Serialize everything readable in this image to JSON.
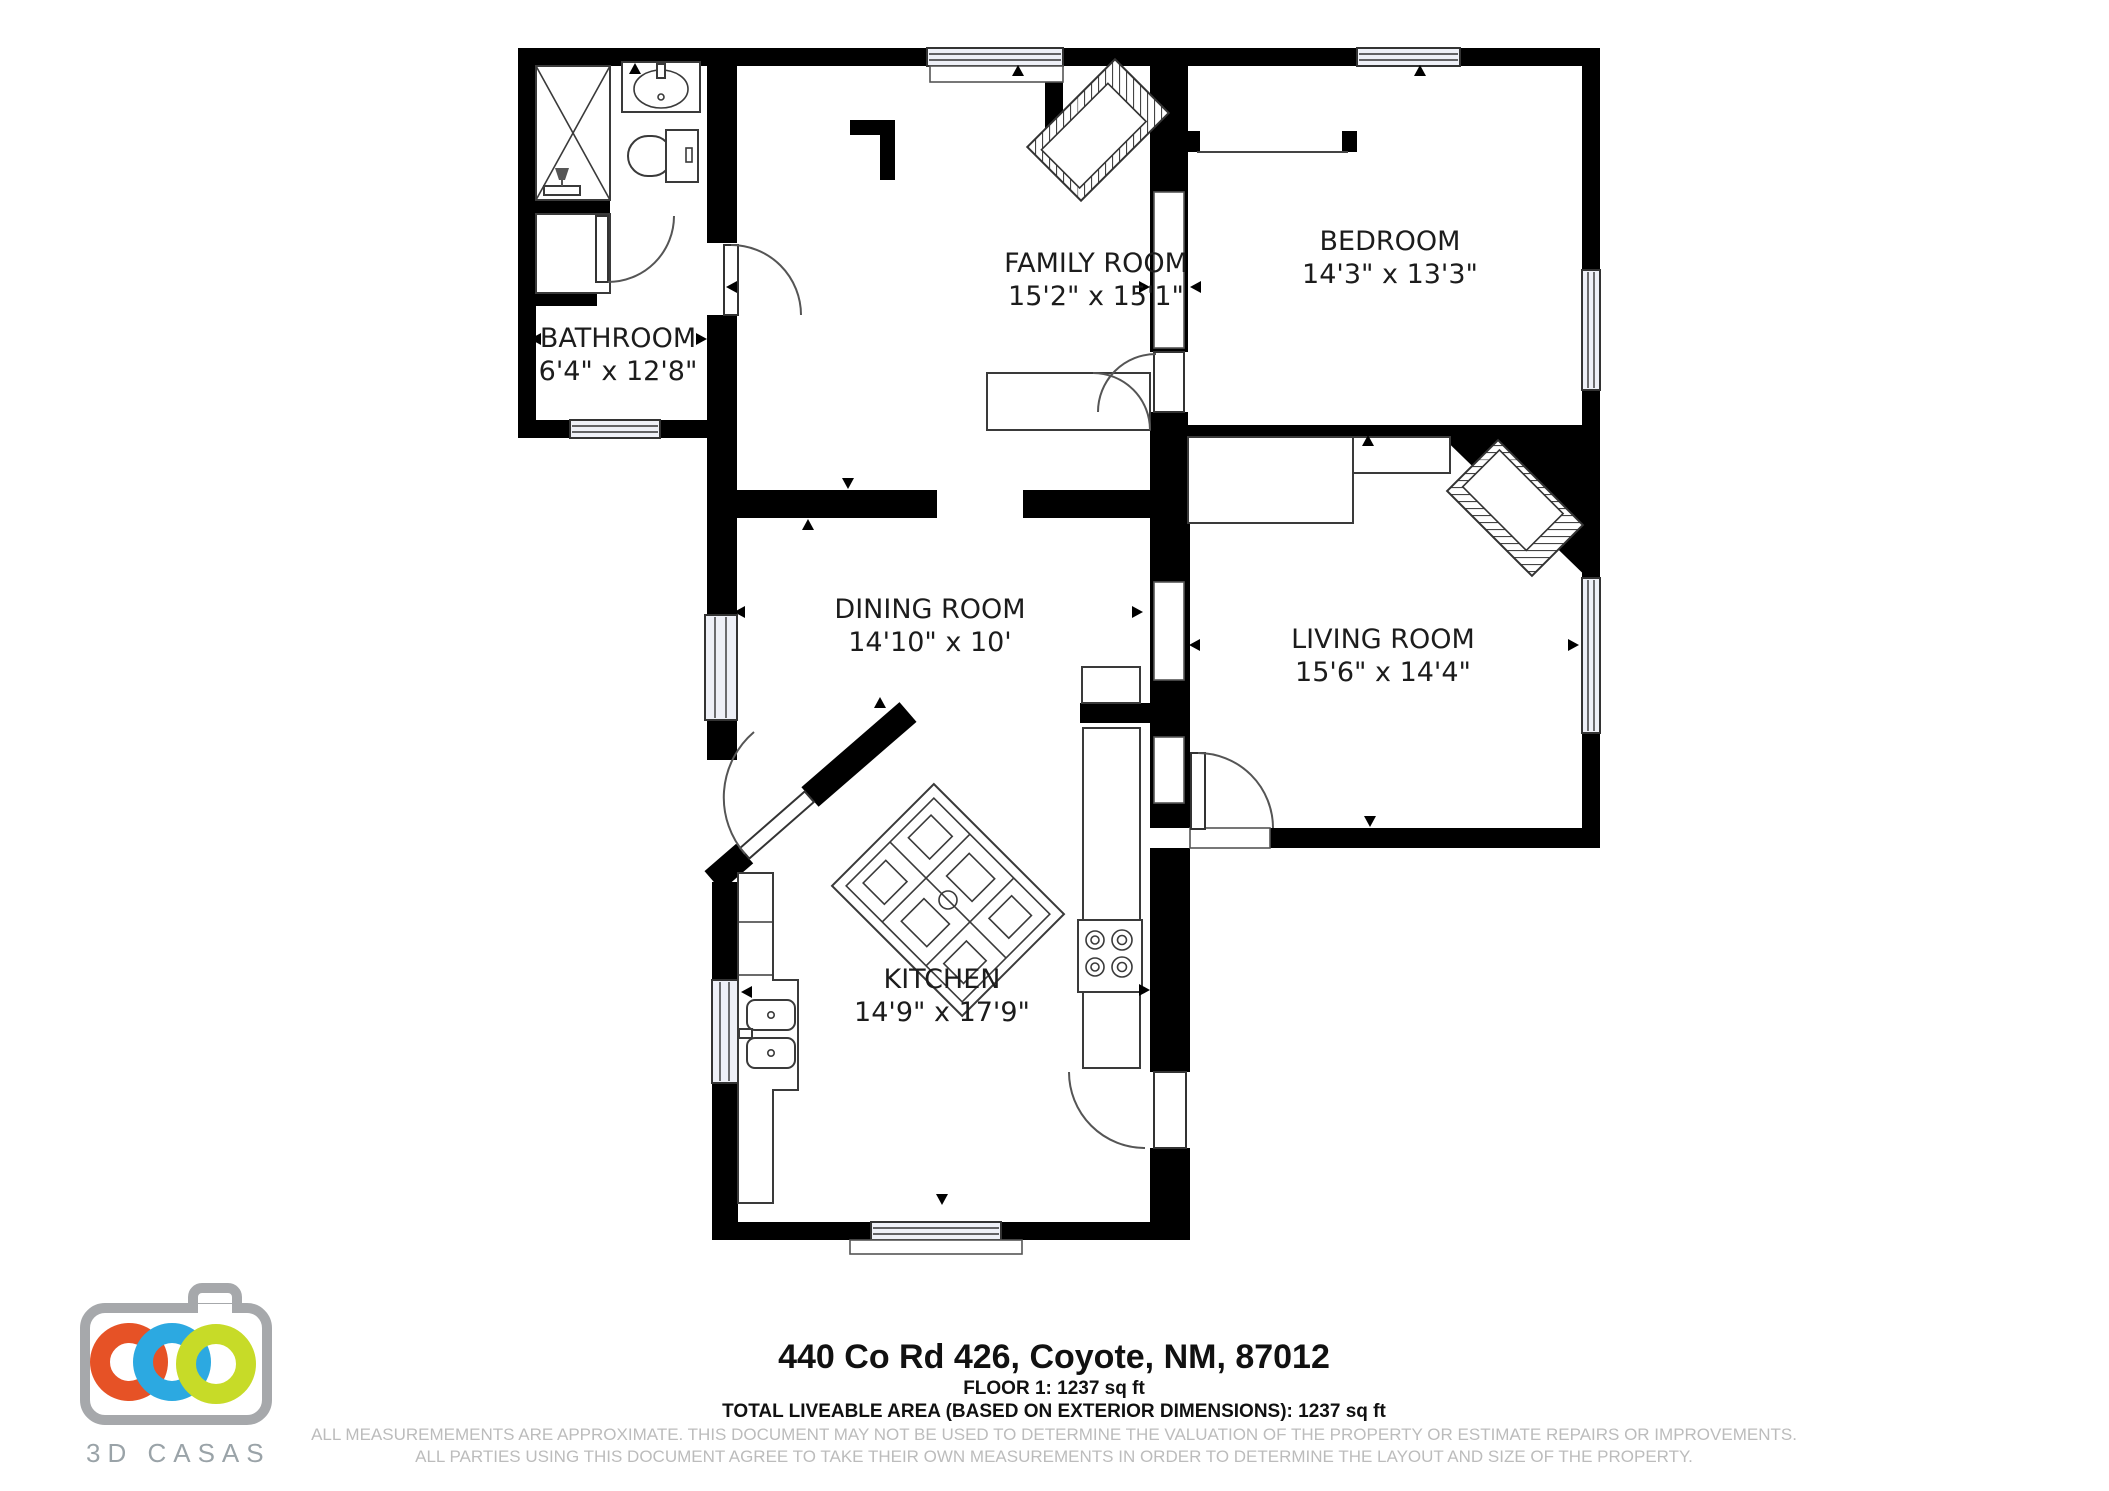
{
  "floor_plan": {
    "rooms": {
      "family": {
        "name": "FAMILY ROOM",
        "dims": "15'2\" x 15'1\""
      },
      "bedroom": {
        "name": "BEDROOM",
        "dims": "14'3\" x 13'3\""
      },
      "bathroom": {
        "name": "BATHROOM",
        "dims": "6'4\" x 12'8\""
      },
      "dining": {
        "name": "DINING ROOM",
        "dims": "14'10\" x 10'"
      },
      "living": {
        "name": "LIVING ROOM",
        "dims": "15'6\" x 14'4\""
      },
      "kitchen": {
        "name": "KITCHEN",
        "dims": "14'9\" x 17'9\""
      }
    }
  },
  "footer": {
    "address": "440 Co Rd 426, Coyote, NM, 87012",
    "floor_info": "FLOOR 1: 1237 sq ft",
    "total_area": "TOTAL LIVEABLE AREA (BASED ON EXTERIOR DIMENSIONS): 1237 sq ft",
    "disclaimer_line1": "ALL MEASUREMEMENTS ARE APPROXIMATE. THIS DOCUMENT MAY NOT BE USED TO DETERMINE THE VALUATION OF THE PROPERTY OR ESTIMATE REPAIRS OR IMPROVEMENTS.",
    "disclaimer_line2": "ALL PARTIES USING THIS DOCUMENT AGREE TO TAKE THEIR OWN MEASUREMENTS IN ORDER TO DETERMINE THE LAYOUT AND SIZE OF THE PROPERTY."
  },
  "logo": {
    "brand": "3D CASAS",
    "ring_colors": {
      "orange": "#E65226",
      "blue": "#2CA9E1",
      "green": "#C7DB28"
    },
    "body_color": "#A6A8AB"
  }
}
